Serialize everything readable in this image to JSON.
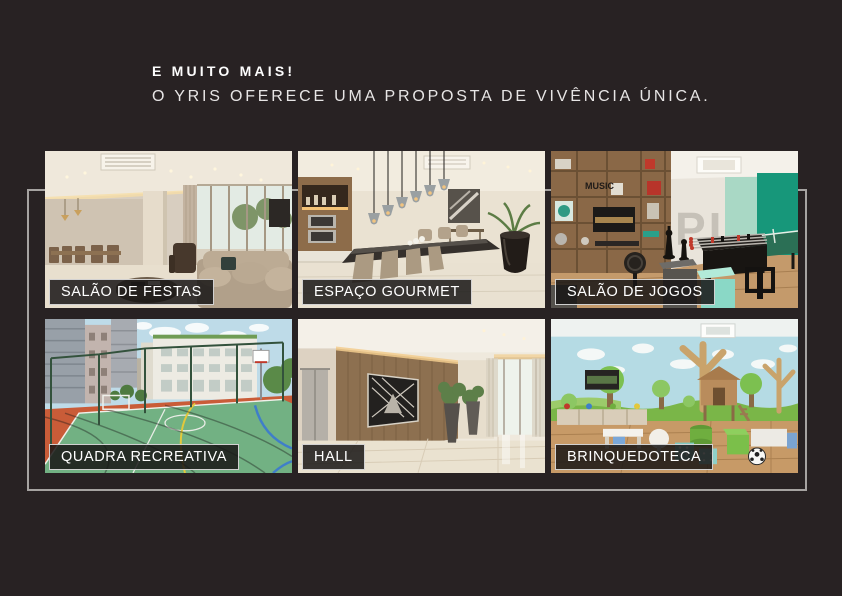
{
  "page": {
    "background_color": "#282223",
    "frame_color": "#a6a3a1"
  },
  "header": {
    "title": "E MUITO MAIS!",
    "subtitle": "O YRIS OFERECE UMA PROPOSTA DE VIVÊNCIA ÚNICA."
  },
  "tiles": [
    {
      "label": "SALÃO DE FESTAS"
    },
    {
      "label": "ESPAÇO GOURMET"
    },
    {
      "label": "SALÃO DE JOGOS",
      "wall_text": "PING",
      "shelf_text": "MUSIC"
    },
    {
      "label": "QUADRA RECREATIVA"
    },
    {
      "label": "HALL"
    },
    {
      "label": "BRINQUEDOTECA"
    }
  ]
}
